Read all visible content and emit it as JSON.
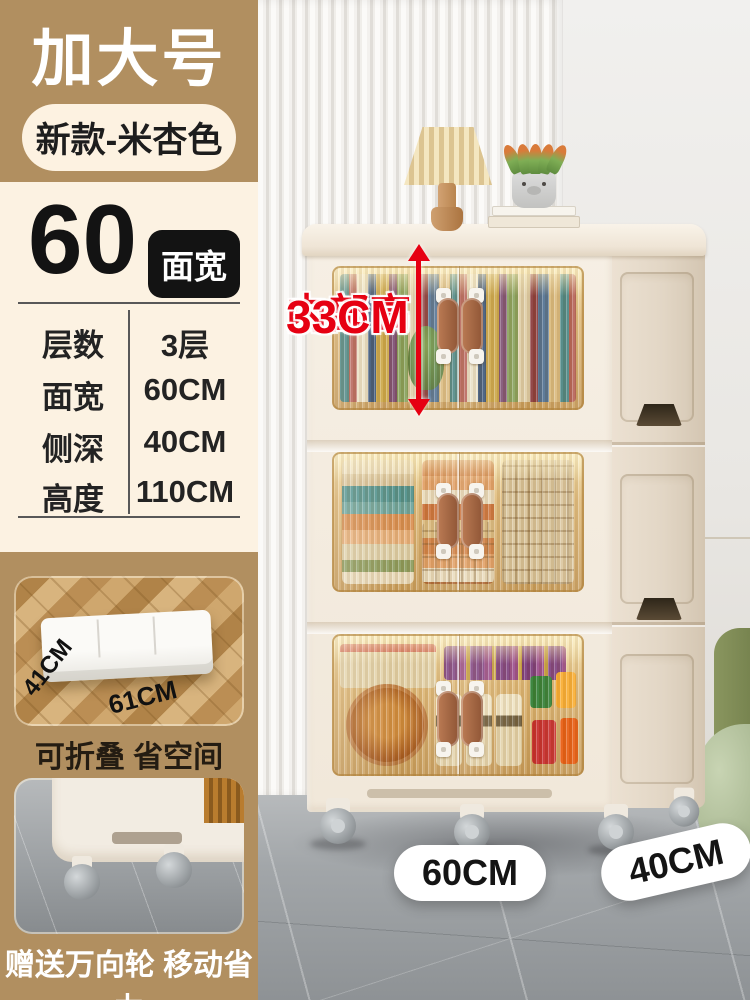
{
  "header": {
    "size_label": "加大号",
    "variant_pill": "新款-米杏色"
  },
  "width_panel": {
    "number": "60",
    "unit_badge": "面宽"
  },
  "specs": {
    "rows": [
      {
        "label": "层数",
        "value": "3层"
      },
      {
        "label": "面宽",
        "value": "60CM"
      },
      {
        "label": "侧深",
        "value": "40CM"
      },
      {
        "label": "高度",
        "value": "110CM"
      }
    ]
  },
  "annotation": {
    "line1": "内部高",
    "line2": "33CM"
  },
  "floor_labels": {
    "front_width": "60CM",
    "side_depth": "40CM"
  },
  "features": [
    {
      "dim_a": "41CM",
      "dim_b": "61CM",
      "caption": "可折叠 省空间"
    },
    {
      "caption": "赠送万向轮 移动省力"
    }
  ],
  "colors": {
    "tan": "#b18f60",
    "cream": "#fcf2e2",
    "accent_red": "#e60012",
    "badge_black": "#131313",
    "cabinet_body": "#f3ebdf",
    "glass_amber": "#deb774"
  }
}
